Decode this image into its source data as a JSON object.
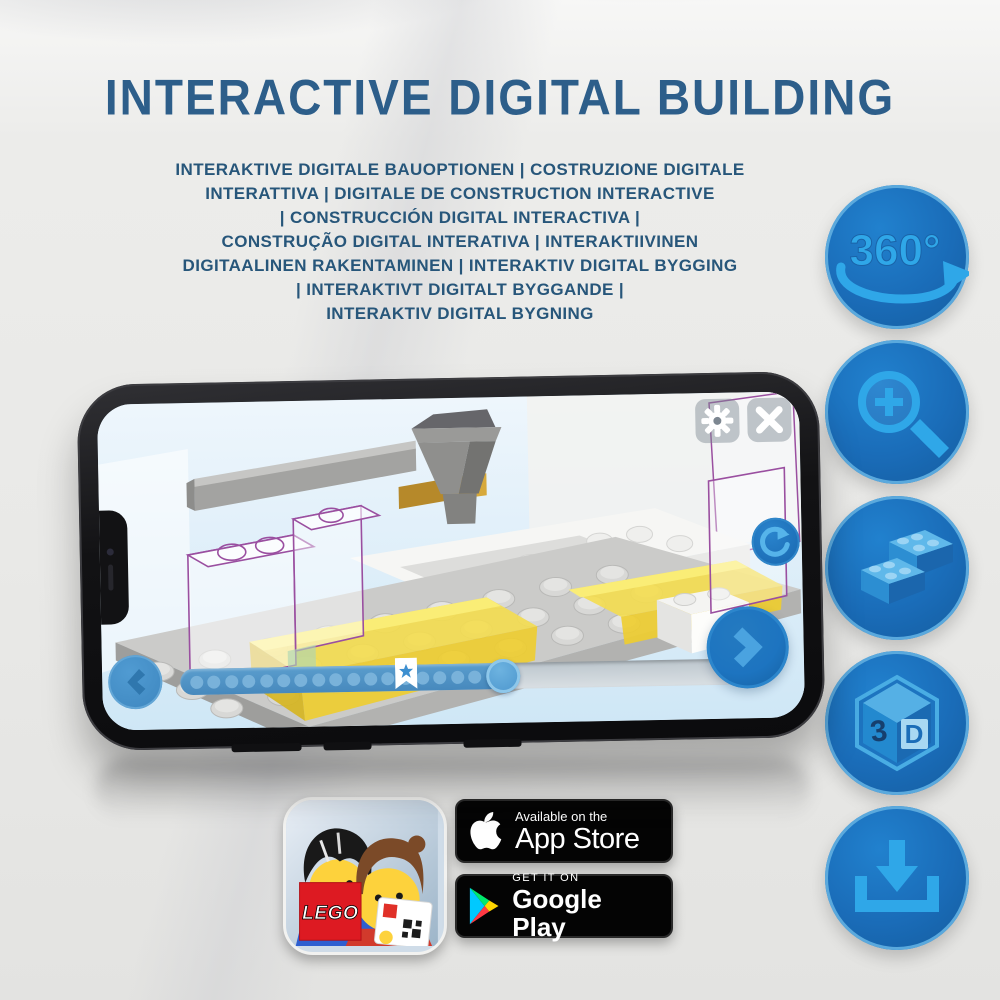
{
  "title": "INTERACTIVE DIGITAL BUILDING",
  "subtitle_lines": [
    "INTERAKTIVE DIGITALE BAUOPTIONEN | COSTRUZIONE DIGITALE",
    "INTERATTIVA | DIGITALE DE CONSTRUCTION INTERACTIVE",
    "| CONSTRUCCIÓN DIGITAL INTERACTIVA |",
    "CONSTRUÇÃO DIGITAL INTERATIVA | INTERAKTIIVINEN",
    "DIGITAALINEN RAKENTAMINEN | INTERAKTIV DIGITAL BYGGING",
    "| INTERAKTIVT DIGITALT BYGGANDE |",
    "INTERAKTIV DIGITAL BYGNING"
  ],
  "features": [
    {
      "icon": "360-rotation-icon",
      "label": "360°"
    },
    {
      "icon": "zoom-in-magnifier-icon"
    },
    {
      "icon": "lego-bricks-icon"
    },
    {
      "icon": "3d-cube-icon",
      "face_left": "3",
      "face_right": "D"
    },
    {
      "icon": "download-icon"
    }
  ],
  "phone": {
    "screen": {
      "view": "lego-3d-building-instructions",
      "buttons": {
        "settings": "gear-icon",
        "close": "x-icon",
        "rotate": "rotate-clockwise-icon",
        "back": "chevron-left-icon",
        "next": "chevron-right-icon"
      },
      "progress": {
        "percent_complete": 57,
        "bookmark_percent": 38,
        "step_dots": 18
      }
    }
  },
  "store_badges": {
    "app_store": {
      "tagline": "Available on the",
      "store_name": "App Store"
    },
    "google_play": {
      "tagline": "GET IT ON",
      "store_name": "Google Play"
    }
  },
  "lego_app": {
    "logo_text": "LEGO"
  },
  "colors": {
    "title_blue": "#2d5e8a",
    "subtitle_blue": "#27567a",
    "circle_blue": "#1a6cb8",
    "glyph_blue": "#2fa7e8",
    "yellow_brick": "#f0d344",
    "ghost_outline_purple": "#9a4fa0",
    "badge_black": "#040404"
  }
}
